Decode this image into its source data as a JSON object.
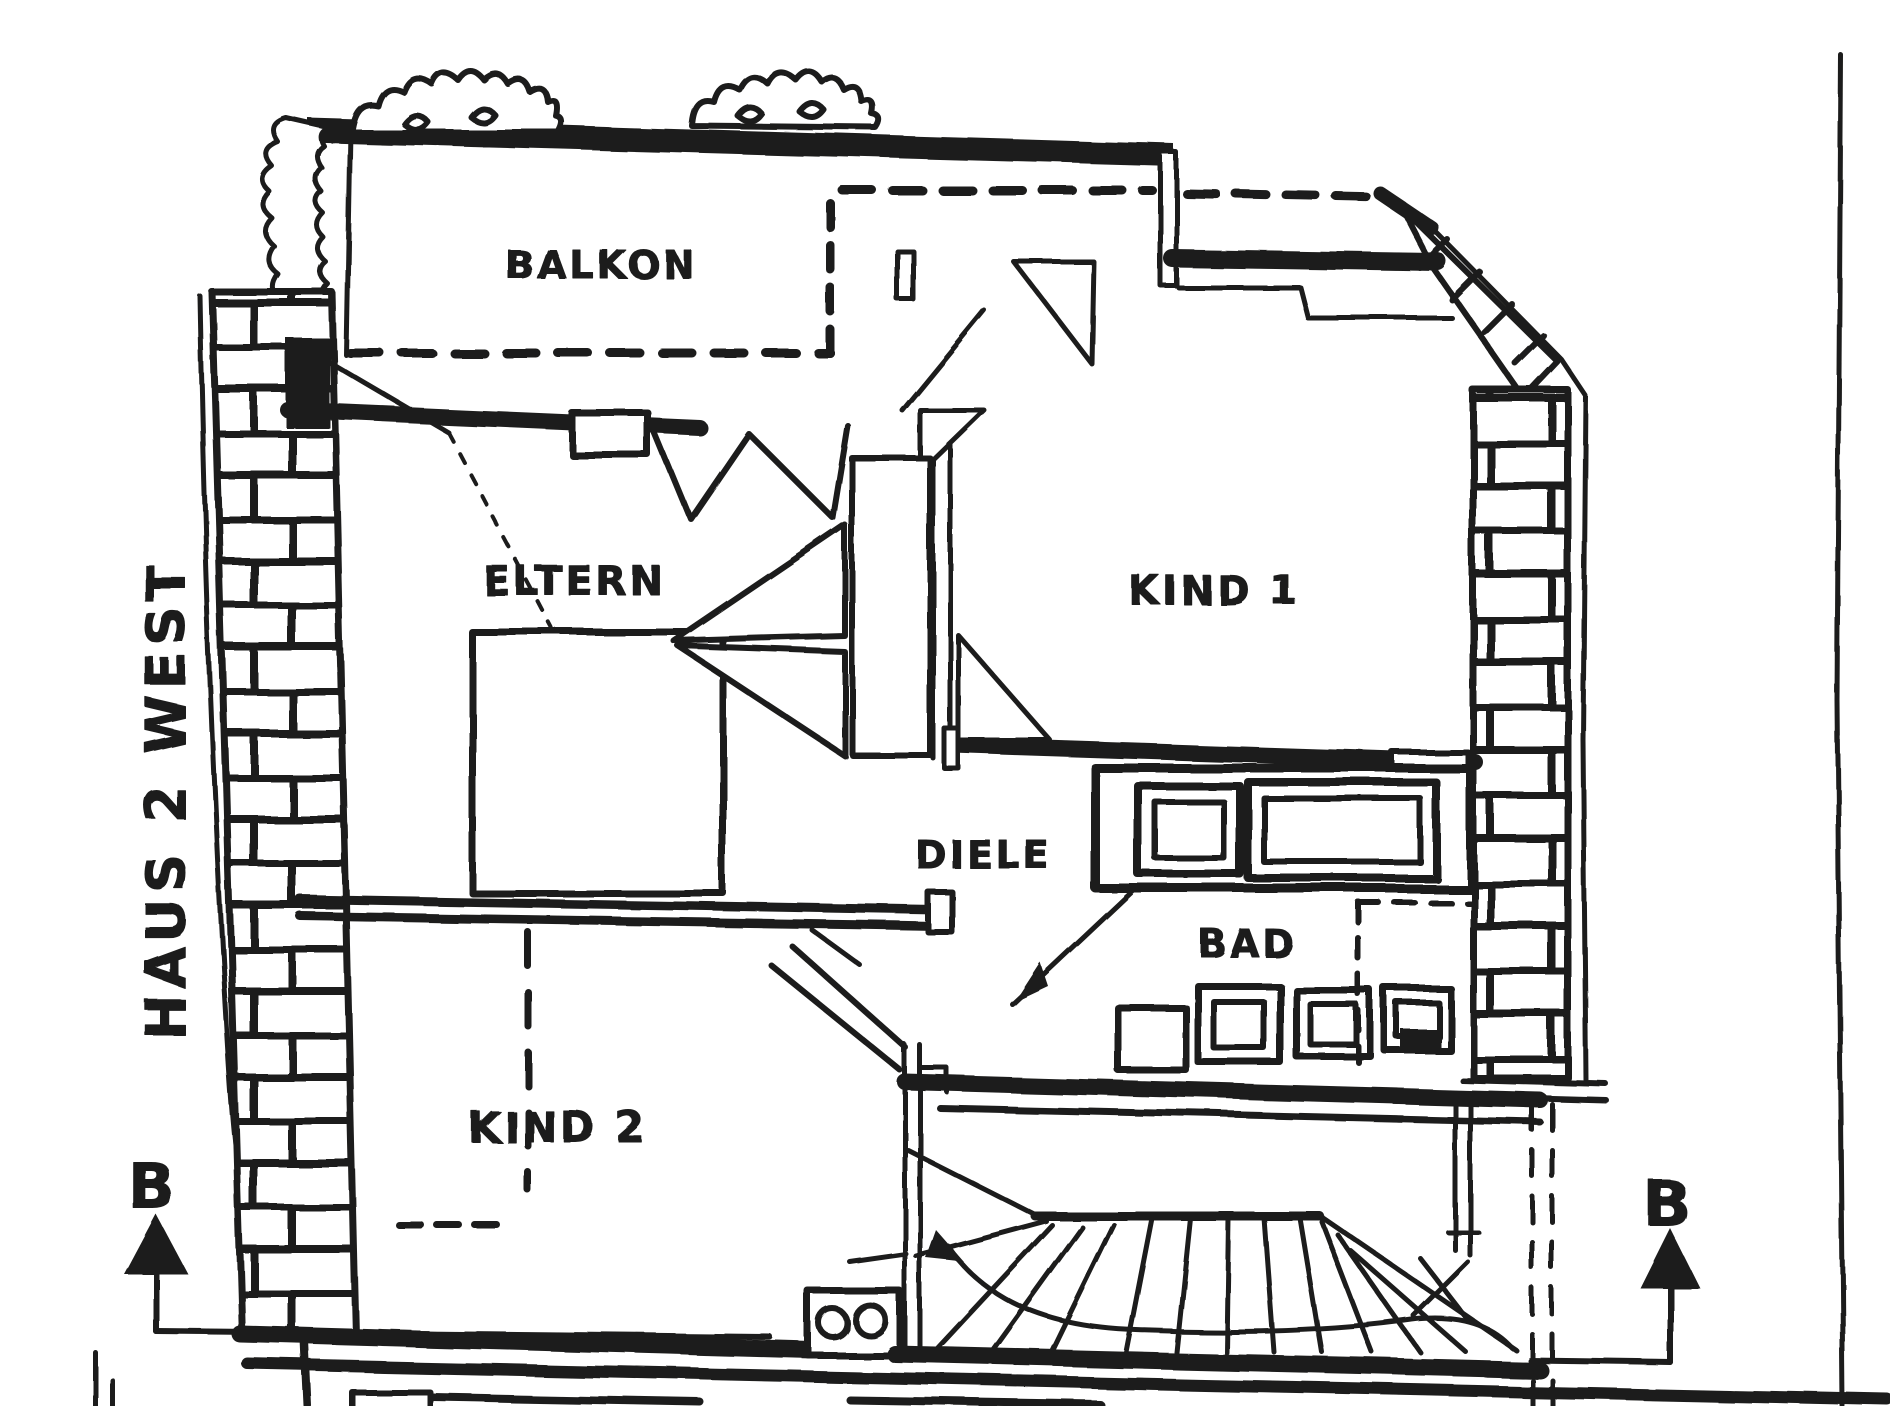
{
  "plan": {
    "title": "HAUS 2 WEST",
    "rooms": {
      "balkon": "BALKON",
      "eltern": "ELTERN",
      "kind1": "KIND 1",
      "kind2": "KIND 2",
      "diele": "DIELE",
      "bad": "BAD"
    },
    "section_marker_left": "B",
    "section_marker_right": "B",
    "colors": {
      "ink": "#1d1d1b",
      "paper": "#ffffff"
    }
  }
}
